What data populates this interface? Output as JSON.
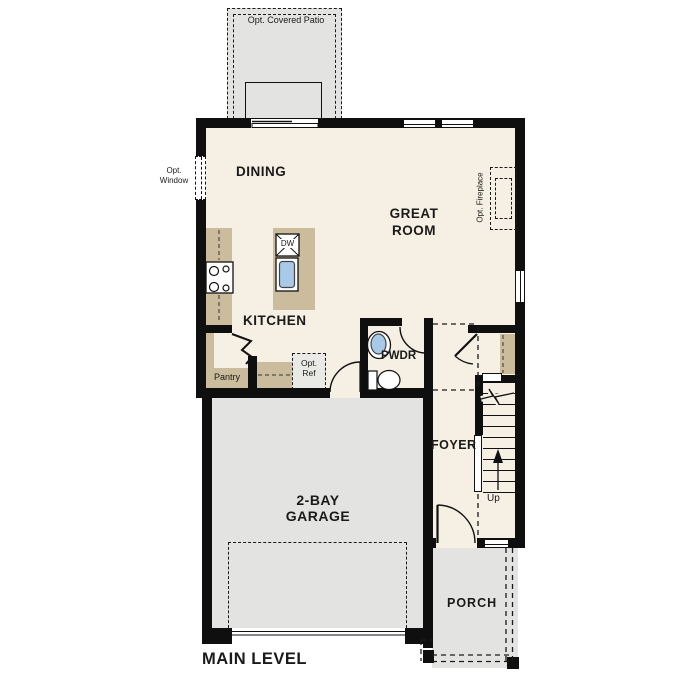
{
  "title": "MAIN LEVEL",
  "rooms": {
    "dining": "DINING",
    "great_l1": "GREAT",
    "great_l2": "ROOM",
    "kitchen": "KITCHEN",
    "pantry": "Pantry",
    "pwdr": "PWDR",
    "foyer": "FOYER",
    "garage_l1": "2-BAY",
    "garage_l2": "GARAGE",
    "porch": "PORCH"
  },
  "options": {
    "covered_patio": "Opt. Covered Patio",
    "window_l1": "Opt.",
    "window_l2": "Window",
    "fireplace": "Opt. Fireplace",
    "ref_l1": "Opt.",
    "ref_l2": "Ref"
  },
  "stairs": {
    "up": "Up"
  },
  "fixtures": {
    "dishwasher": "DW"
  },
  "colors": {
    "wall": "#0f0f0f",
    "living_floor": "#f6efe3",
    "garage_floor": "#e3e3e1",
    "counter": "#cbbc9e",
    "sink_blue": "#a9c9e9",
    "optional_fill": "#e9e9e6"
  }
}
